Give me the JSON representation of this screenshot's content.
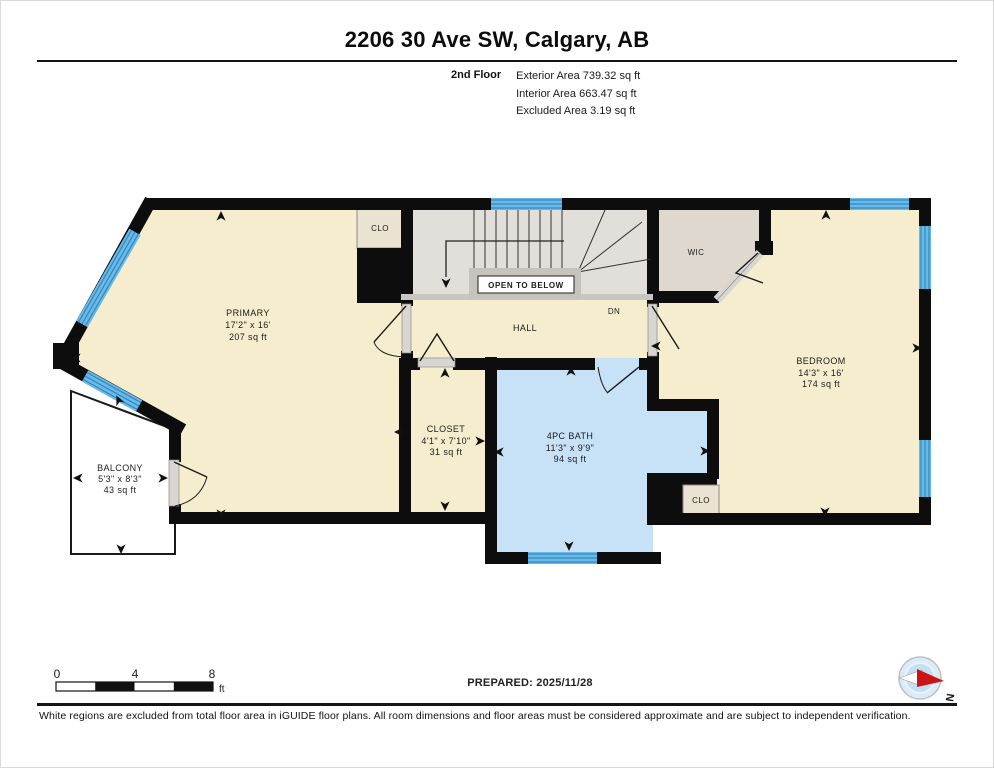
{
  "header": {
    "title": "2206 30 Ave SW, Calgary, AB",
    "floor_label": "2nd Floor",
    "stats": [
      "Exterior Area 739.32 sq ft",
      "Interior Area 663.47 sq ft",
      "Excluded Area 3.19 sq ft"
    ]
  },
  "plan": {
    "rooms": [
      {
        "name": "PRIMARY",
        "dims": "17'2\" x 16'",
        "area": "207 sq ft"
      },
      {
        "name": "BALCONY",
        "dims": "5'3\" x 8'3\"",
        "area": "43 sq ft"
      },
      {
        "name": "CLOSET",
        "dims": "4'1\" x 7'10\"",
        "area": "31 sq ft"
      },
      {
        "name": "4PC BATH",
        "dims": "11'3\" x 9'9\"",
        "area": "94 sq ft"
      },
      {
        "name": "BEDROOM",
        "dims": "14'3\" x 16'",
        "area": "174 sq ft"
      }
    ],
    "labels": {
      "hall": "HALL",
      "wic": "WIC",
      "closet_top": "CLO",
      "closet_bath": "CLO",
      "down": "DN",
      "open_to_below": "OPEN TO BELOW"
    }
  },
  "scale_bar": {
    "tick0": "0",
    "tick1": "4",
    "tick2": "8",
    "unit": "ft"
  },
  "footer": {
    "prepared": "PREPARED: 2025/11/28",
    "compass_north": "N",
    "disclaimer": "White regions are excluded from total floor area in iGUIDE floor plans. All room dimensions and floor areas must be considered approximate and are subject to independent verification."
  },
  "colors": {
    "room_fill": "#F6ECCE",
    "bath_fill": "#C7E2F6",
    "window_blue": "#6BB9E6",
    "wall": "#0D0D0D"
  }
}
